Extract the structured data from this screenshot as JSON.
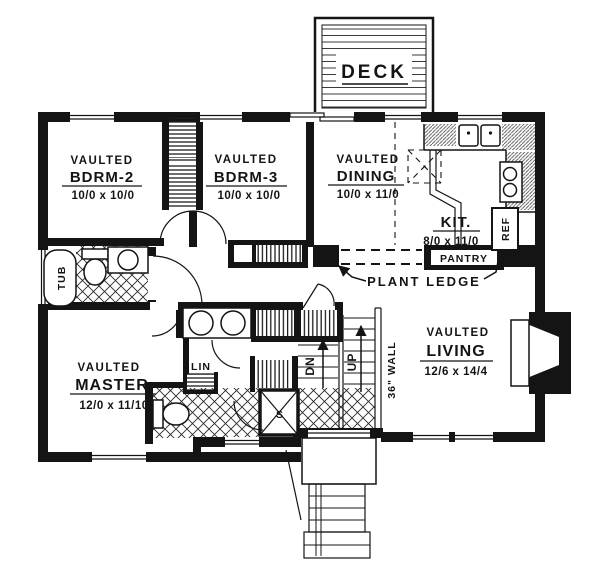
{
  "meta": {
    "title": "Split-level house first floor plan",
    "ink_color": "#141414",
    "paper_color": "#ffffff"
  },
  "deck": {
    "label": "DECK"
  },
  "rooms": {
    "bdrm2": {
      "vaulted": "VAULTED",
      "name": "BDRM-2",
      "dims": "10/0 x 10/0"
    },
    "bdrm3": {
      "vaulted": "VAULTED",
      "name": "BDRM-3",
      "dims": "10/0 x 10/0"
    },
    "dining": {
      "vaulted": "VAULTED",
      "name": "DINING",
      "dims": "10/0 x 11/0"
    },
    "kitchen": {
      "name": "KIT.",
      "dims": "8/0 x 11/0"
    },
    "master": {
      "vaulted": "VAULTED",
      "name": "MASTER",
      "dims": "12/0 x 11/10"
    },
    "living": {
      "vaulted": "VAULTED",
      "name": "LIVING",
      "dims": "12/6 x 14/4"
    }
  },
  "labels": {
    "pantry": "PANTRY",
    "plant_ledge": "PLANT LEDGE",
    "ref": "REF",
    "tub": "TUB",
    "lin": "LIN",
    "shower": "S",
    "down": "DN",
    "up": "UP",
    "wall36": "36\" WALL"
  }
}
